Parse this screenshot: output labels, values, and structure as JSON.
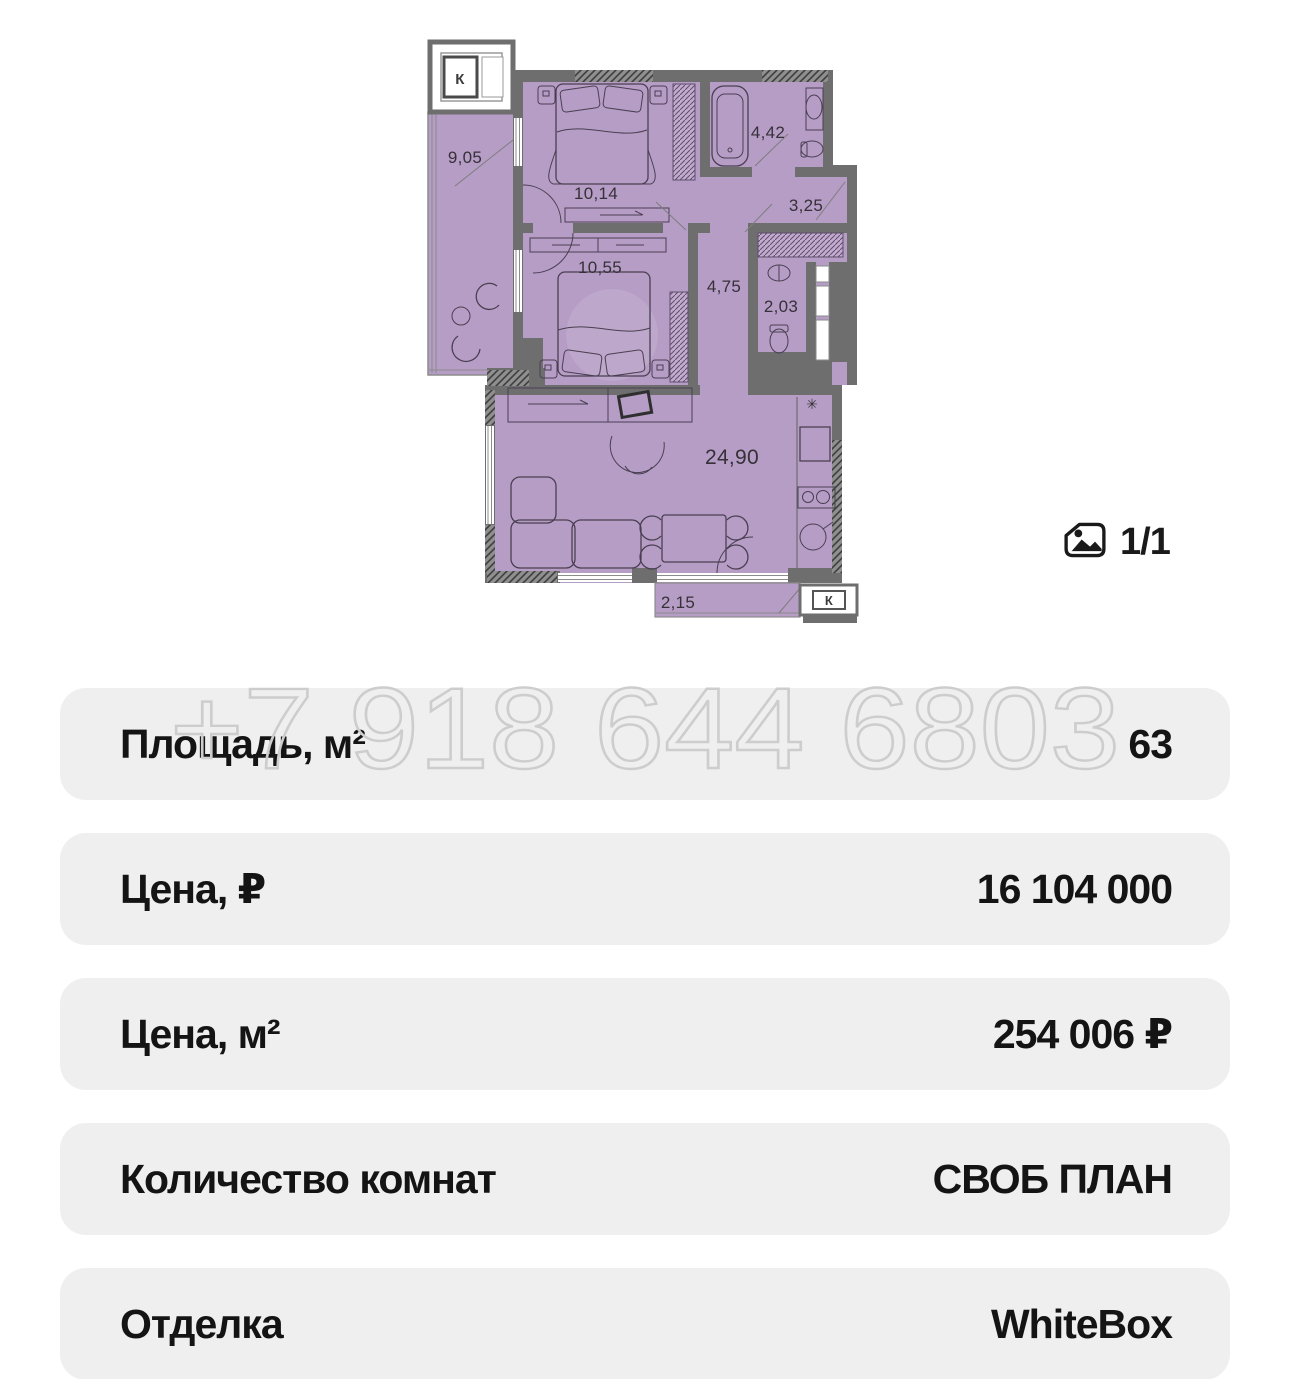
{
  "gallery": {
    "counter": "1/1"
  },
  "watermark": {
    "phone": "+7 918 644 6803"
  },
  "floorplan": {
    "shaft_top": "К",
    "shaft_bottom": "К",
    "kitchen_symbol": "✳",
    "rooms": {
      "loggia": "9,05",
      "bedroom1": "10,14",
      "bathroom": "4,42",
      "hallway": "3,25",
      "bedroom2": "10,55",
      "hall": "4,75",
      "wc": "2,03",
      "living": "24,90",
      "balcony": "2,15"
    },
    "colors": {
      "room_fill": "#b69dc5",
      "wall": "#6e6e6e"
    }
  },
  "details": {
    "rows": [
      {
        "label": "Площадь, м²",
        "value": "63"
      },
      {
        "label": "Цена, ₽",
        "value": "16 104 000"
      },
      {
        "label": "Цена, м²",
        "value": "254 006 ₽"
      },
      {
        "label": "Количество комнат",
        "value": "СВОБ ПЛАН"
      },
      {
        "label": "Отделка",
        "value": "WhiteBox"
      }
    ]
  }
}
